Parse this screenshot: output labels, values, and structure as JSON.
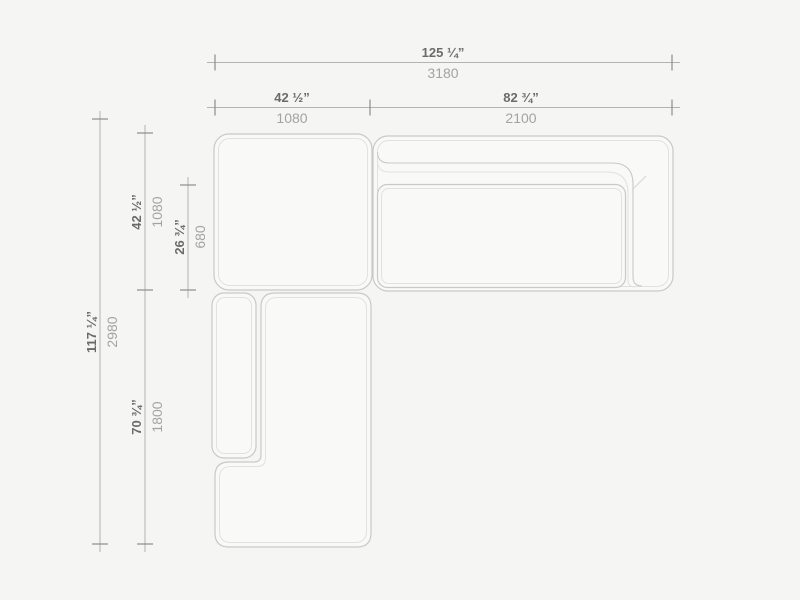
{
  "drawing": {
    "title": "sectional-sofa-plan-dimension-drawing",
    "units": [
      "inches",
      "millimeters"
    ]
  },
  "colors": {
    "bg": "#f5f5f4",
    "module_fill": "#f9f9f8",
    "stroke_outer": "#c9c9c9",
    "stroke_inner": "#e1e1e0",
    "seam": "#d6d6d5",
    "dim_line": "#b3b3b2",
    "tick": "#8c8c8b",
    "text_inches": "#6b6b6a",
    "text_mm": "#a3a3a2"
  },
  "dims": {
    "w_total": {
      "in": "125 ¼”",
      "mm": "3180"
    },
    "w_left": {
      "in": "42 ½”",
      "mm": "1080"
    },
    "w_right": {
      "in": "82 ¾”",
      "mm": "2100"
    },
    "h_total": {
      "in": "117 ¼”",
      "mm": "2980"
    },
    "h_top": {
      "in": "42 ½”",
      "mm": "1080"
    },
    "h_top_inner": {
      "in": "26 ¾”",
      "mm": "680"
    },
    "h_bottom": {
      "in": "70 ¾”",
      "mm": "1800"
    }
  }
}
